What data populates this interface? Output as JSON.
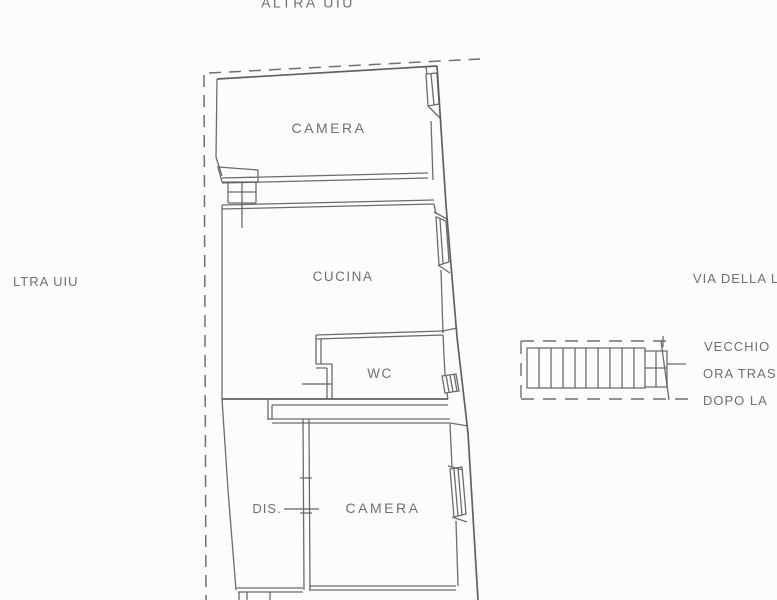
{
  "page": {
    "kind": "floor-plan-scan",
    "background": "#fcfcfb",
    "line_color": "#5f5f5f",
    "text_color": "#6f6f6f"
  },
  "plan": {
    "boundary_label_top": "ALTRA UIU",
    "boundary_label_left": "LTRA UIU",
    "street_label": "VIA DELLA L",
    "rooms": {
      "camera_top": "CAMERA",
      "cucina": "CUCINA",
      "wc": "WC",
      "dis": "DIS.",
      "camera_bottom": "CAMERA"
    },
    "stair_notes": {
      "line1": "VECCHIO",
      "line2": "ORA TRAS",
      "line3": "DOPO LA"
    }
  }
}
